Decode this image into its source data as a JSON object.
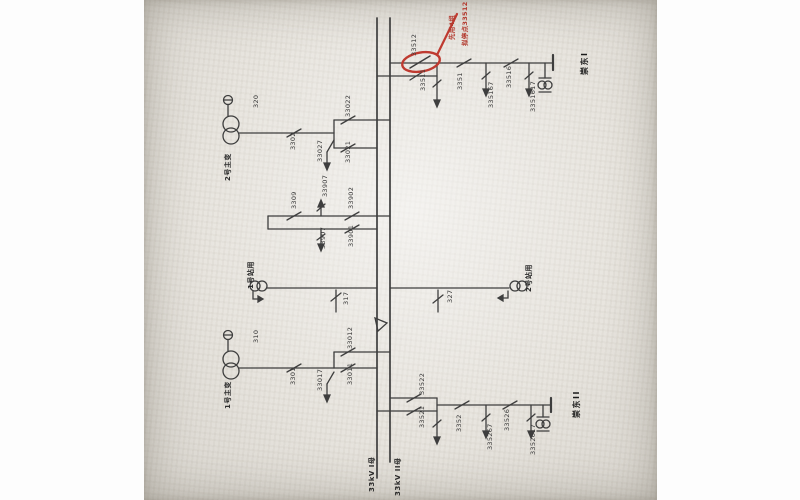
{
  "diagram": {
    "type": "substation-single-line",
    "buses": [
      {
        "id": "bus1",
        "label": "33kV I母"
      },
      {
        "id": "bus2",
        "label": "33kV II母"
      }
    ],
    "annotation": {
      "circled_device": "33512",
      "note_line1": "拟停点33512",
      "note_line2": "先用4组",
      "highlight_color": "#bf3a30"
    },
    "colors": {
      "ink": "#3e3e3e",
      "paper": "#e8e5df",
      "red": "#bf3a30"
    },
    "labels": [
      {
        "id": "d33512",
        "text": "33512",
        "x": 267,
        "y": 56,
        "kind": "device"
      },
      {
        "id": "d33511",
        "text": "33511",
        "x": 276,
        "y": 91,
        "kind": "device"
      },
      {
        "id": "d3351",
        "text": "3351",
        "x": 313,
        "y": 90,
        "kind": "device"
      },
      {
        "id": "d335167",
        "text": "335167",
        "x": 344,
        "y": 108,
        "kind": "device"
      },
      {
        "id": "d33516",
        "text": "33516",
        "x": 362,
        "y": 88,
        "kind": "device"
      },
      {
        "id": "d3351617",
        "text": "3351617",
        "x": 386,
        "y": 112,
        "kind": "device"
      },
      {
        "id": "line1",
        "text": "崇东I",
        "x": 436,
        "y": 75,
        "kind": "name"
      },
      {
        "id": "note1",
        "text": "拟停点33512",
        "x": 318,
        "y": 46,
        "kind": "red"
      },
      {
        "id": "note2",
        "text": "先用4组",
        "x": 305,
        "y": 40,
        "kind": "red"
      },
      {
        "id": "d320",
        "text": "320",
        "x": 109,
        "y": 108,
        "kind": "device"
      },
      {
        "id": "d3302",
        "text": "3302",
        "x": 146,
        "y": 150,
        "kind": "device"
      },
      {
        "id": "d33022",
        "text": "33022",
        "x": 201,
        "y": 117,
        "kind": "device"
      },
      {
        "id": "d33021",
        "text": "33021",
        "x": 201,
        "y": 163,
        "kind": "device"
      },
      {
        "id": "d33027",
        "text": "33027",
        "x": 173,
        "y": 162,
        "kind": "device"
      },
      {
        "id": "t2",
        "text": "2号主变",
        "x": 80,
        "y": 181,
        "kind": "name-sm"
      },
      {
        "id": "d3309",
        "text": "3309",
        "x": 147,
        "y": 209,
        "kind": "device"
      },
      {
        "id": "d33907a",
        "text": "33907",
        "x": 178,
        "y": 197,
        "kind": "device"
      },
      {
        "id": "d33902",
        "text": "33902",
        "x": 204,
        "y": 209,
        "kind": "device"
      },
      {
        "id": "d33901",
        "text": "33901",
        "x": 204,
        "y": 247,
        "kind": "device"
      },
      {
        "id": "d33907b",
        "text": "33907",
        "x": 176,
        "y": 249,
        "kind": "device"
      },
      {
        "id": "d317",
        "text": "317",
        "x": 199,
        "y": 305,
        "kind": "device"
      },
      {
        "id": "st1",
        "text": "1号站用",
        "x": 103,
        "y": 289,
        "kind": "name-sm"
      },
      {
        "id": "d327",
        "text": "327",
        "x": 303,
        "y": 303,
        "kind": "device"
      },
      {
        "id": "st2",
        "text": "2号站用",
        "x": 381,
        "y": 292,
        "kind": "name-sm"
      },
      {
        "id": "d310",
        "text": "310",
        "x": 109,
        "y": 343,
        "kind": "device"
      },
      {
        "id": "d3301",
        "text": "3301",
        "x": 146,
        "y": 385,
        "kind": "device"
      },
      {
        "id": "d33012",
        "text": "33012",
        "x": 203,
        "y": 349,
        "kind": "device"
      },
      {
        "id": "d33011",
        "text": "33011",
        "x": 203,
        "y": 385,
        "kind": "device"
      },
      {
        "id": "d33017",
        "text": "33017",
        "x": 173,
        "y": 391,
        "kind": "device"
      },
      {
        "id": "t1",
        "text": "1号主变",
        "x": 80,
        "y": 409,
        "kind": "name-sm"
      },
      {
        "id": "d33522",
        "text": "33522",
        "x": 275,
        "y": 395,
        "kind": "device"
      },
      {
        "id": "d33521",
        "text": "33521",
        "x": 275,
        "y": 428,
        "kind": "device"
      },
      {
        "id": "d3352",
        "text": "3352",
        "x": 312,
        "y": 432,
        "kind": "device"
      },
      {
        "id": "d335267",
        "text": "335267",
        "x": 343,
        "y": 450,
        "kind": "device"
      },
      {
        "id": "d33526",
        "text": "33526",
        "x": 360,
        "y": 431,
        "kind": "device"
      },
      {
        "id": "d3352617",
        "text": "3352617",
        "x": 386,
        "y": 455,
        "kind": "device"
      },
      {
        "id": "line2",
        "text": "崇东II",
        "x": 428,
        "y": 418,
        "kind": "name"
      },
      {
        "id": "bus1",
        "text": "33kV I母",
        "x": 224,
        "y": 492,
        "kind": "bus"
      },
      {
        "id": "bus2",
        "text": "33kV II母",
        "x": 250,
        "y": 496,
        "kind": "bus"
      }
    ]
  }
}
